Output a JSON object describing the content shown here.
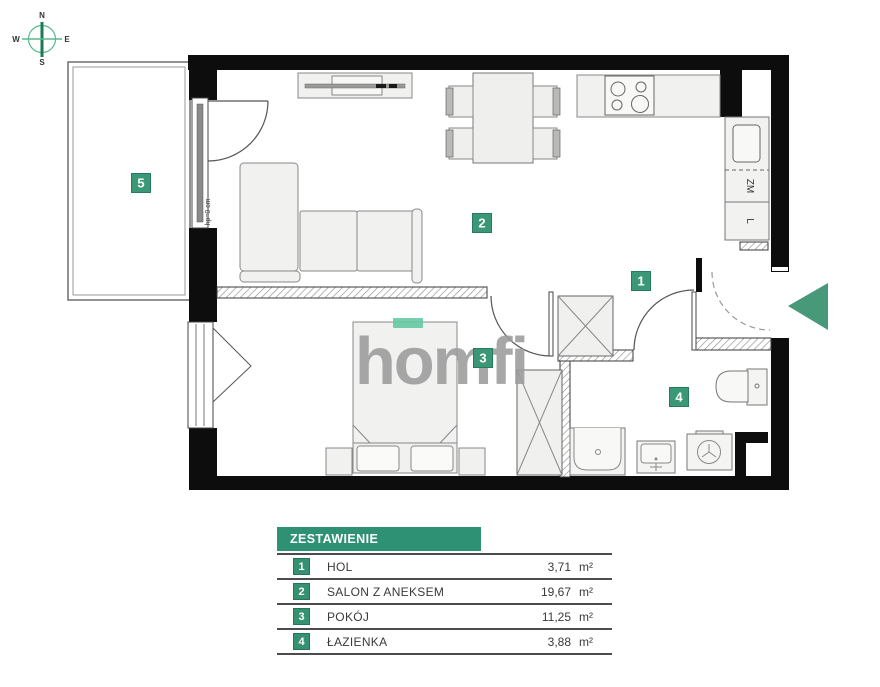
{
  "compass": {
    "n": "N",
    "s": "S",
    "e": "E",
    "w": "W"
  },
  "watermark": {
    "text": "homfi"
  },
  "colors": {
    "table_green": "#2f9173",
    "badge_green": "#35916f",
    "label_green": "#3b9877",
    "arrow_green": "#47997a",
    "logo_gray": "#9b9b9b",
    "logo_accent_mint": "#62c9a2",
    "wall_black": "#0d0d0d"
  },
  "floor_plan": {
    "room_labels": [
      {
        "id": "1",
        "x": 641,
        "y": 281
      },
      {
        "id": "2",
        "x": 482,
        "y": 223
      },
      {
        "id": "3",
        "x": 483,
        "y": 358
      },
      {
        "id": "4",
        "x": 679,
        "y": 397
      },
      {
        "id": "5",
        "x": 141,
        "y": 183
      }
    ],
    "appliance_labels": [
      {
        "text": "ZM",
        "x": 747,
        "y": 186,
        "rotation": 90
      },
      {
        "text": "L",
        "x": 747,
        "y": 221,
        "rotation": 90
      }
    ],
    "annotations": [
      {
        "text": "hp=0 cm",
        "x": 210,
        "y": 212,
        "rotation": -90
      }
    ]
  },
  "legend_table": {
    "title": "ZESTAWIENIE POMIESZCZEŃ:",
    "rows": [
      {
        "no": "1",
        "name": "HOL",
        "area": "3,71",
        "unit": "m²"
      },
      {
        "no": "2",
        "name": "SALON Z ANEKSEM",
        "area": "19,67",
        "unit": "m²"
      },
      {
        "no": "3",
        "name": "POKÓJ",
        "area": "11,25",
        "unit": "m²"
      },
      {
        "no": "4",
        "name": "ŁAZIENKA",
        "area": "3,88",
        "unit": "m²"
      }
    ]
  }
}
